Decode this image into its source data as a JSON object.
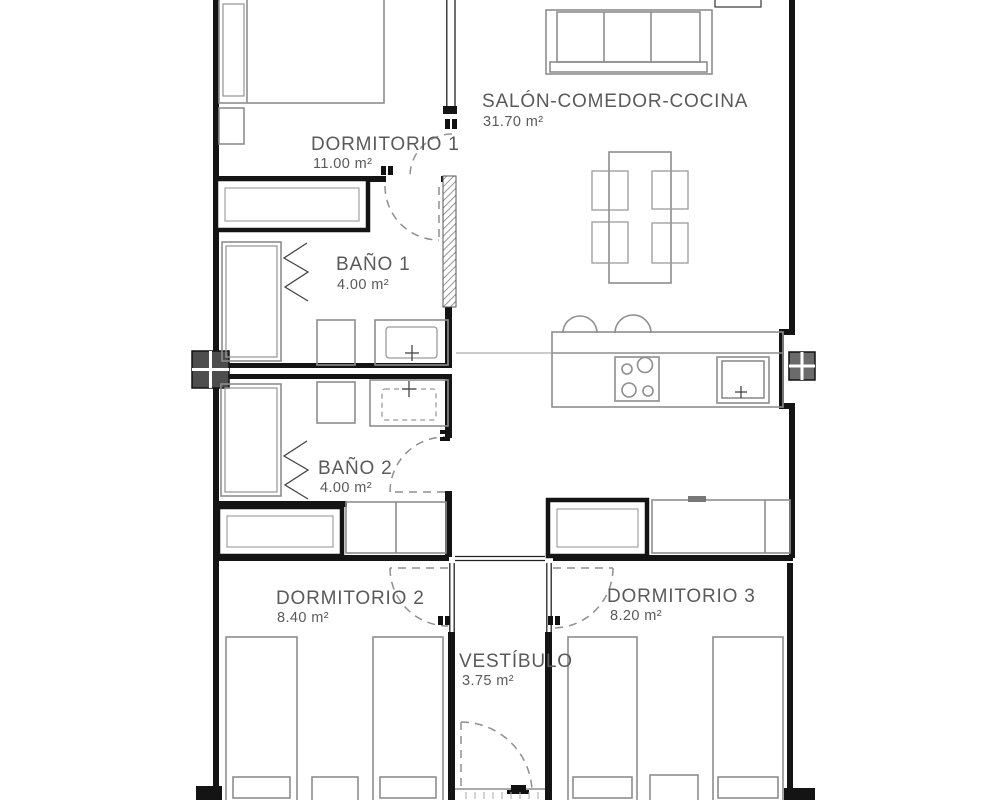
{
  "plan": {
    "type": "apartment-floor-plan",
    "background": "#ffffff",
    "colors": {
      "wall": "#141414",
      "furniture_line": "#8e8e8e",
      "label_text": "#5a5a5a",
      "door_dash": "#8f8f8f",
      "pillar_left": "#4d4d4d",
      "pillar_right": "#6b6b6b"
    },
    "rooms": [
      {
        "id": "dormitorio-1",
        "name": "DORMITORIO 1",
        "area": "11.00 m²",
        "furniture": [
          "double-bed",
          "pillow",
          "nightstand",
          "wardrobe"
        ]
      },
      {
        "id": "salon-comedor-cocina",
        "name": "SALÓN-COMEDOR-COCINA",
        "area": "31.70 m²",
        "furniture": [
          "sofa",
          "side-table",
          "dining-table",
          "chair-x4",
          "kitchen-counter",
          "hob",
          "kitchen-sink",
          "bar-stool-x2",
          "cabinet-run"
        ]
      },
      {
        "id": "bano-1",
        "name": "BAÑO 1",
        "area": "4.00 m²",
        "furniture": [
          "shower-tray",
          "folding-screen",
          "toilet",
          "washbasin"
        ]
      },
      {
        "id": "bano-2",
        "name": "BAÑO 2",
        "area": "4.00 m²",
        "furniture": [
          "shower-tray",
          "folding-screen",
          "toilet",
          "washbasin"
        ]
      },
      {
        "id": "dormitorio-2",
        "name": "DORMITORIO 2",
        "area": "8.40 m²",
        "furniture": [
          "single-bed-x2",
          "nightstand",
          "wardrobe"
        ]
      },
      {
        "id": "dormitorio-3",
        "name": "DORMITORIO 3",
        "area": "8.20 m²",
        "furniture": [
          "single-bed-x2",
          "nightstand"
        ]
      },
      {
        "id": "vestibulo",
        "name": "VESTÍBULO",
        "area": "3.75 m²",
        "furniture": [
          "entry-door"
        ]
      }
    ]
  }
}
